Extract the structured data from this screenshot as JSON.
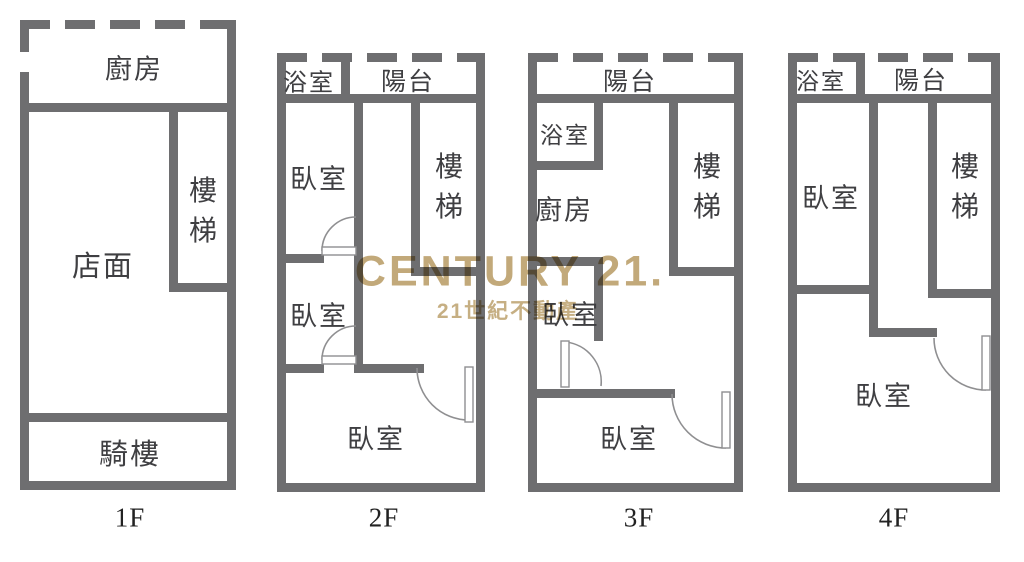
{
  "watermark": {
    "title": "CENTURY 21.",
    "subtitle": "21世紀不動產"
  },
  "colors": {
    "wall": "#6e6e70",
    "label_text": "#3f3f42",
    "watermark_gold": "#ba9d68"
  },
  "floors": [
    {
      "name": "1F",
      "rooms": {
        "kitchen": "廚房",
        "storefront": "店面",
        "stairs": "樓梯",
        "arcade": "騎樓"
      }
    },
    {
      "name": "2F",
      "rooms": {
        "bathroom": "浴室",
        "balcony": "陽台",
        "bedroom1": "臥室",
        "bedroom2": "臥室",
        "stairs": "樓梯",
        "bedroom3": "臥室"
      }
    },
    {
      "name": "3F",
      "rooms": {
        "balcony": "陽台",
        "bathroom": "浴室",
        "kitchen": "廚房",
        "stairs": "樓梯",
        "bedroom1": "臥室",
        "bedroom2": "臥室"
      }
    },
    {
      "name": "4F",
      "rooms": {
        "bathroom": "浴室",
        "balcony": "陽台",
        "bedroom1": "臥室",
        "stairs": "樓梯",
        "bedroom2": "臥室"
      }
    }
  ]
}
